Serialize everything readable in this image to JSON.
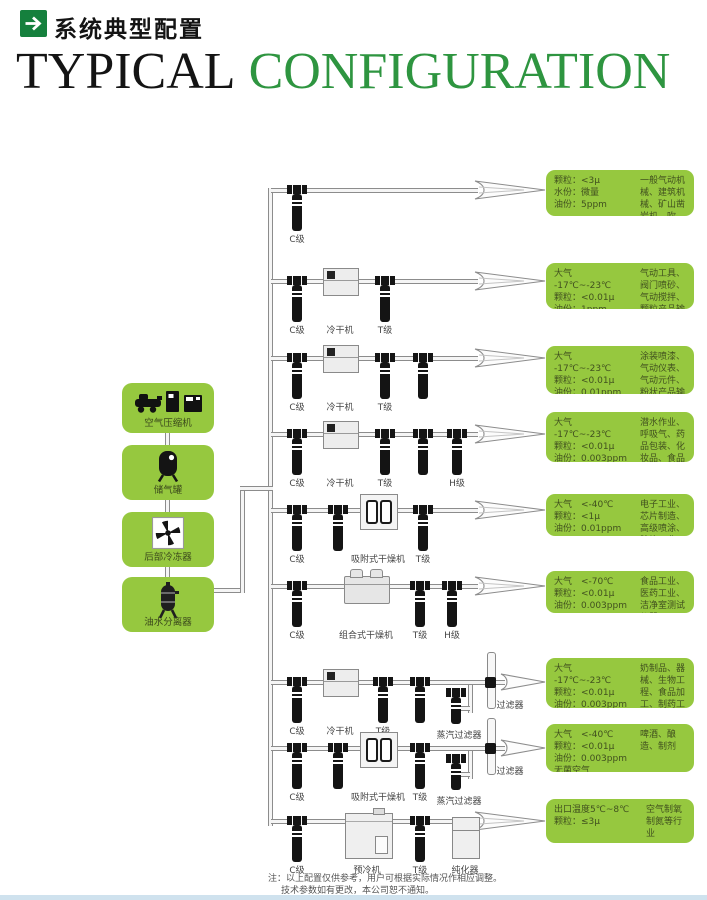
{
  "page": {
    "title_zh": "系统典型配置",
    "title_en_part1": "TYPICAL",
    "title_en_part2": "CONFIGURATION",
    "notes_line1": "注：以上配置仅供参考，用户可根据实际情况作相应调整。",
    "notes_line2": "技术参数如有更改，本公司恕不通知。"
  },
  "colors": {
    "box_green": "#96c83f",
    "title_green": "#2e9540",
    "header_icon_green": "#15803d",
    "pipe_gray": "#8c8c8c",
    "spec_text_green": "#41511f"
  },
  "chain": [
    {
      "label": "空气压缩机",
      "icon": "air-compressor-icon"
    },
    {
      "label": "储气罐",
      "icon": "air-tank-icon"
    },
    {
      "label": "后部冷冻器",
      "icon": "after-cooler-fan-icon"
    },
    {
      "label": "油水分离器",
      "icon": "oil-water-separator-icon"
    }
  ],
  "rows": [
    {
      "labels": [
        "C级"
      ],
      "spec": [
        "颗粒：<3μ",
        "水份：微量",
        "油份：5ppm"
      ],
      "app": "一般气动机械、建筑机械、矿山凿岩机、吹扫、冷冻"
    },
    {
      "labels": [
        "C级",
        "冷干机",
        "T级"
      ],
      "spec": [
        "大气",
        "-17℃~-23℃",
        "颗粒：<0.01μ",
        "油份：1ppm"
      ],
      "app": "气动工具、阀门喷砂、气动搅拌、颗粒产品输送、木工设备"
    },
    {
      "labels": [
        "C级",
        "冷干机",
        "T级"
      ],
      "spec": [
        "大气",
        "-17℃~-23℃",
        "颗粒：<0.01μ",
        "油份：0.01ppm"
      ],
      "app": "涂装喷漆、气动仪表、气动元件、粉状产品输送、烟草工业轴承"
    },
    {
      "labels": [
        "C级",
        "冷干机",
        "T级",
        "H级"
      ],
      "spec": [
        "大气",
        "-17℃~-23℃",
        "颗粒：<0.01μ",
        "油份：0.003ppm",
        "无异味"
      ],
      "app": "潜水作业、呼吸气、药品包装、化妆品、食品配置、罐装"
    },
    {
      "labels": [
        "C级",
        "吸附式干燥机",
        "T级"
      ],
      "spec": [
        "大气　<-40℃",
        "颗粒：<1μ",
        "油份：0.01ppm"
      ],
      "app": "电子工业、芯片制造、高级喷涂、胶片工业、仪表仪器、核工业、航天工业"
    },
    {
      "labels": [
        "C级",
        "组合式干燥机",
        "T级",
        "H级"
      ],
      "spec": [
        "大气　<-70℃",
        "颗粒：<0.01μ",
        "油份：0.003ppm"
      ],
      "app": "食品工业、医药工业、洁净室测试仪器"
    },
    {
      "labels": [
        "C级",
        "冷干机",
        "T级",
        "蒸汽过滤器",
        "过滤器"
      ],
      "spec": [
        "大气",
        "-17℃~-23℃",
        "颗粒：<0.01μ",
        "油份：0.003ppm",
        "无菌空气"
      ],
      "app": "奶制品、器械、生物工程、食品加工、制药工业"
    },
    {
      "labels": [
        "C级",
        "吸附式干燥机",
        "T级",
        "蒸汽过滤器",
        "过滤器"
      ],
      "spec": [
        "大气　<-40℃",
        "颗粒：<0.01μ",
        "油份：0.003ppm",
        "无菌空气"
      ],
      "app": "啤酒、酿造、制剂"
    },
    {
      "labels": [
        "C级",
        "预冷机",
        "T级",
        "纯化器"
      ],
      "spec": [
        "出口温度5℃~8℃",
        "颗粒：≤3μ"
      ],
      "app": "空气制氧\n制氮等行业"
    }
  ]
}
